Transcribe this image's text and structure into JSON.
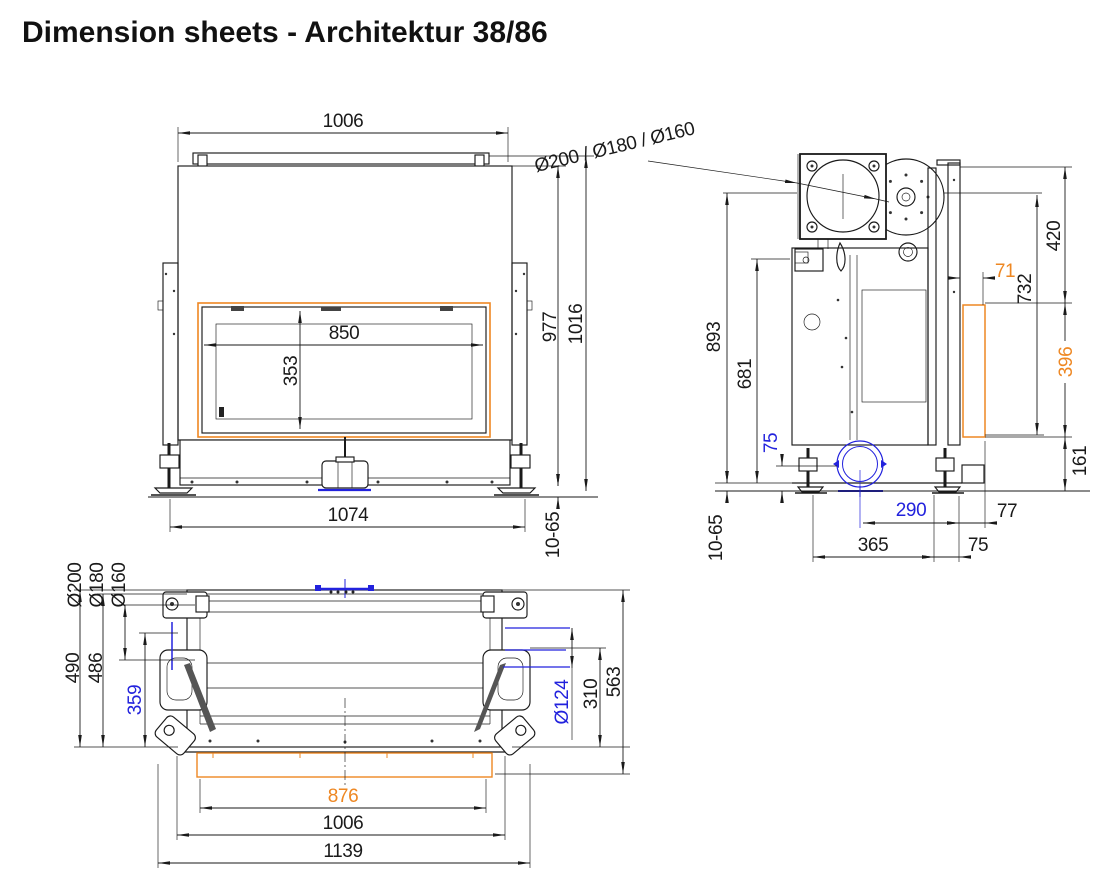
{
  "title": "Dimension sheets - Architektur 38/86",
  "colors": {
    "line": "#1a1a1a",
    "orange": "#EE8722",
    "blue": "#2222DD"
  },
  "front_view": {
    "dim_width_top": "1006",
    "dim_glass_width": "850",
    "dim_glass_height": "353",
    "dim_height_body": "977",
    "dim_height_total": "1016",
    "dim_width_base": "1074",
    "dim_feet_range": "10-65"
  },
  "side_view": {
    "flue_diameters": "Ø200 / Ø180 / Ø160",
    "dim_flue_center_height": "893",
    "dim_firebox_height": "681",
    "dim_depth_top": "420",
    "dim_flue_to_glass_bottom": "732",
    "dim_glass_offset": "71",
    "dim_glass_height": "396",
    "dim_plinth_height": "161",
    "dim_air_height": "75",
    "dim_air_offset": "290",
    "dim_rear_gap": "77",
    "dim_feet_depth": "365",
    "dim_feet_size": "75",
    "dim_feet_range": "10-65"
  },
  "plan_view": {
    "flue_dia_outer": "Ø200",
    "flue_dia_mid": "Ø180",
    "flue_dia_inner": "Ø160",
    "dim_depth_1": "490",
    "dim_depth_2": "486",
    "dim_depth_3": "359",
    "dim_air_dia": "Ø124",
    "dim_depth_4": "310",
    "dim_depth_total": "563",
    "dim_glass_width": "876",
    "dim_body_width": "1006",
    "dim_total_width": "1139"
  }
}
